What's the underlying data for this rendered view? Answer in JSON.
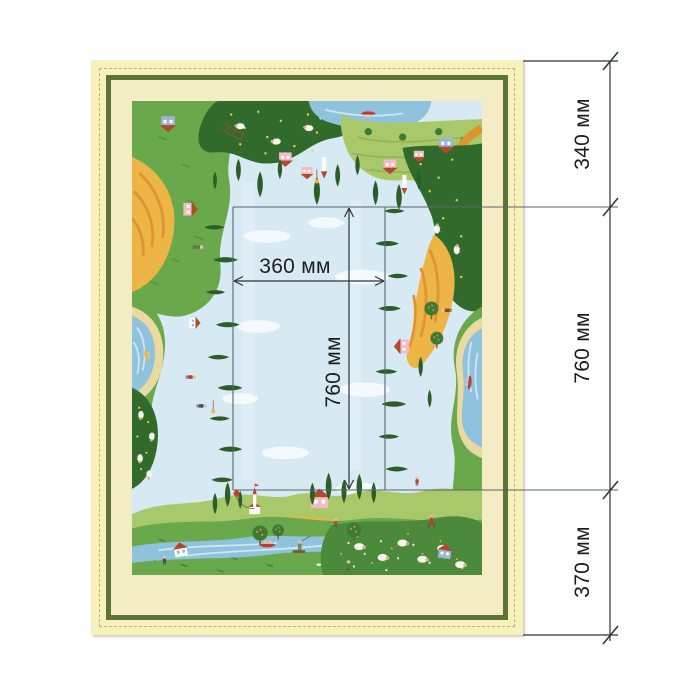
{
  "dimensions": {
    "unit": "мм",
    "outer": [
      {
        "position": "top",
        "label": "340 мм"
      },
      {
        "position": "middle",
        "label": "760 мм"
      },
      {
        "position": "bottom",
        "label": "370 мм"
      }
    ],
    "inner_width_label": "360 мм",
    "inner_height_label": "760 мм"
  },
  "colors": {
    "page_bg": "#ffffff",
    "mat": "#f8f1bc",
    "stitch": "#c2b073",
    "frame": "#5d7439",
    "frame_gap": "#f3ecc4",
    "sky": "#d7eaf4",
    "cloud": "#ffffff",
    "grass": "#6aa84c",
    "grass_dark": "#306b2c",
    "grass_mid": "#4b8a3a",
    "grass_light": "#a9c86a",
    "stripe_light": "#8db14f",
    "field_yellow": "#ecb545",
    "field_orange": "#de9430",
    "water": "#8fc3dd",
    "water_light": "#cfe6f2",
    "sand": "#ead9a0",
    "roof": "#b04a2e",
    "wall_pink": "#f2bcc4",
    "wall_blue": "#9db3d8",
    "wall_white": "#fdfbf4",
    "tree_dark": "#2c5e28",
    "tree_round": "#3d7a33",
    "trunk": "#7a5a2e",
    "sheep": "#f7f4ec",
    "dot_yellow": "#ecd24e",
    "dot_white": "#f4f2e4",
    "dim_line": "#2e3338",
    "ext_line": "#5a636b",
    "label_text": "#1d1d20"
  }
}
